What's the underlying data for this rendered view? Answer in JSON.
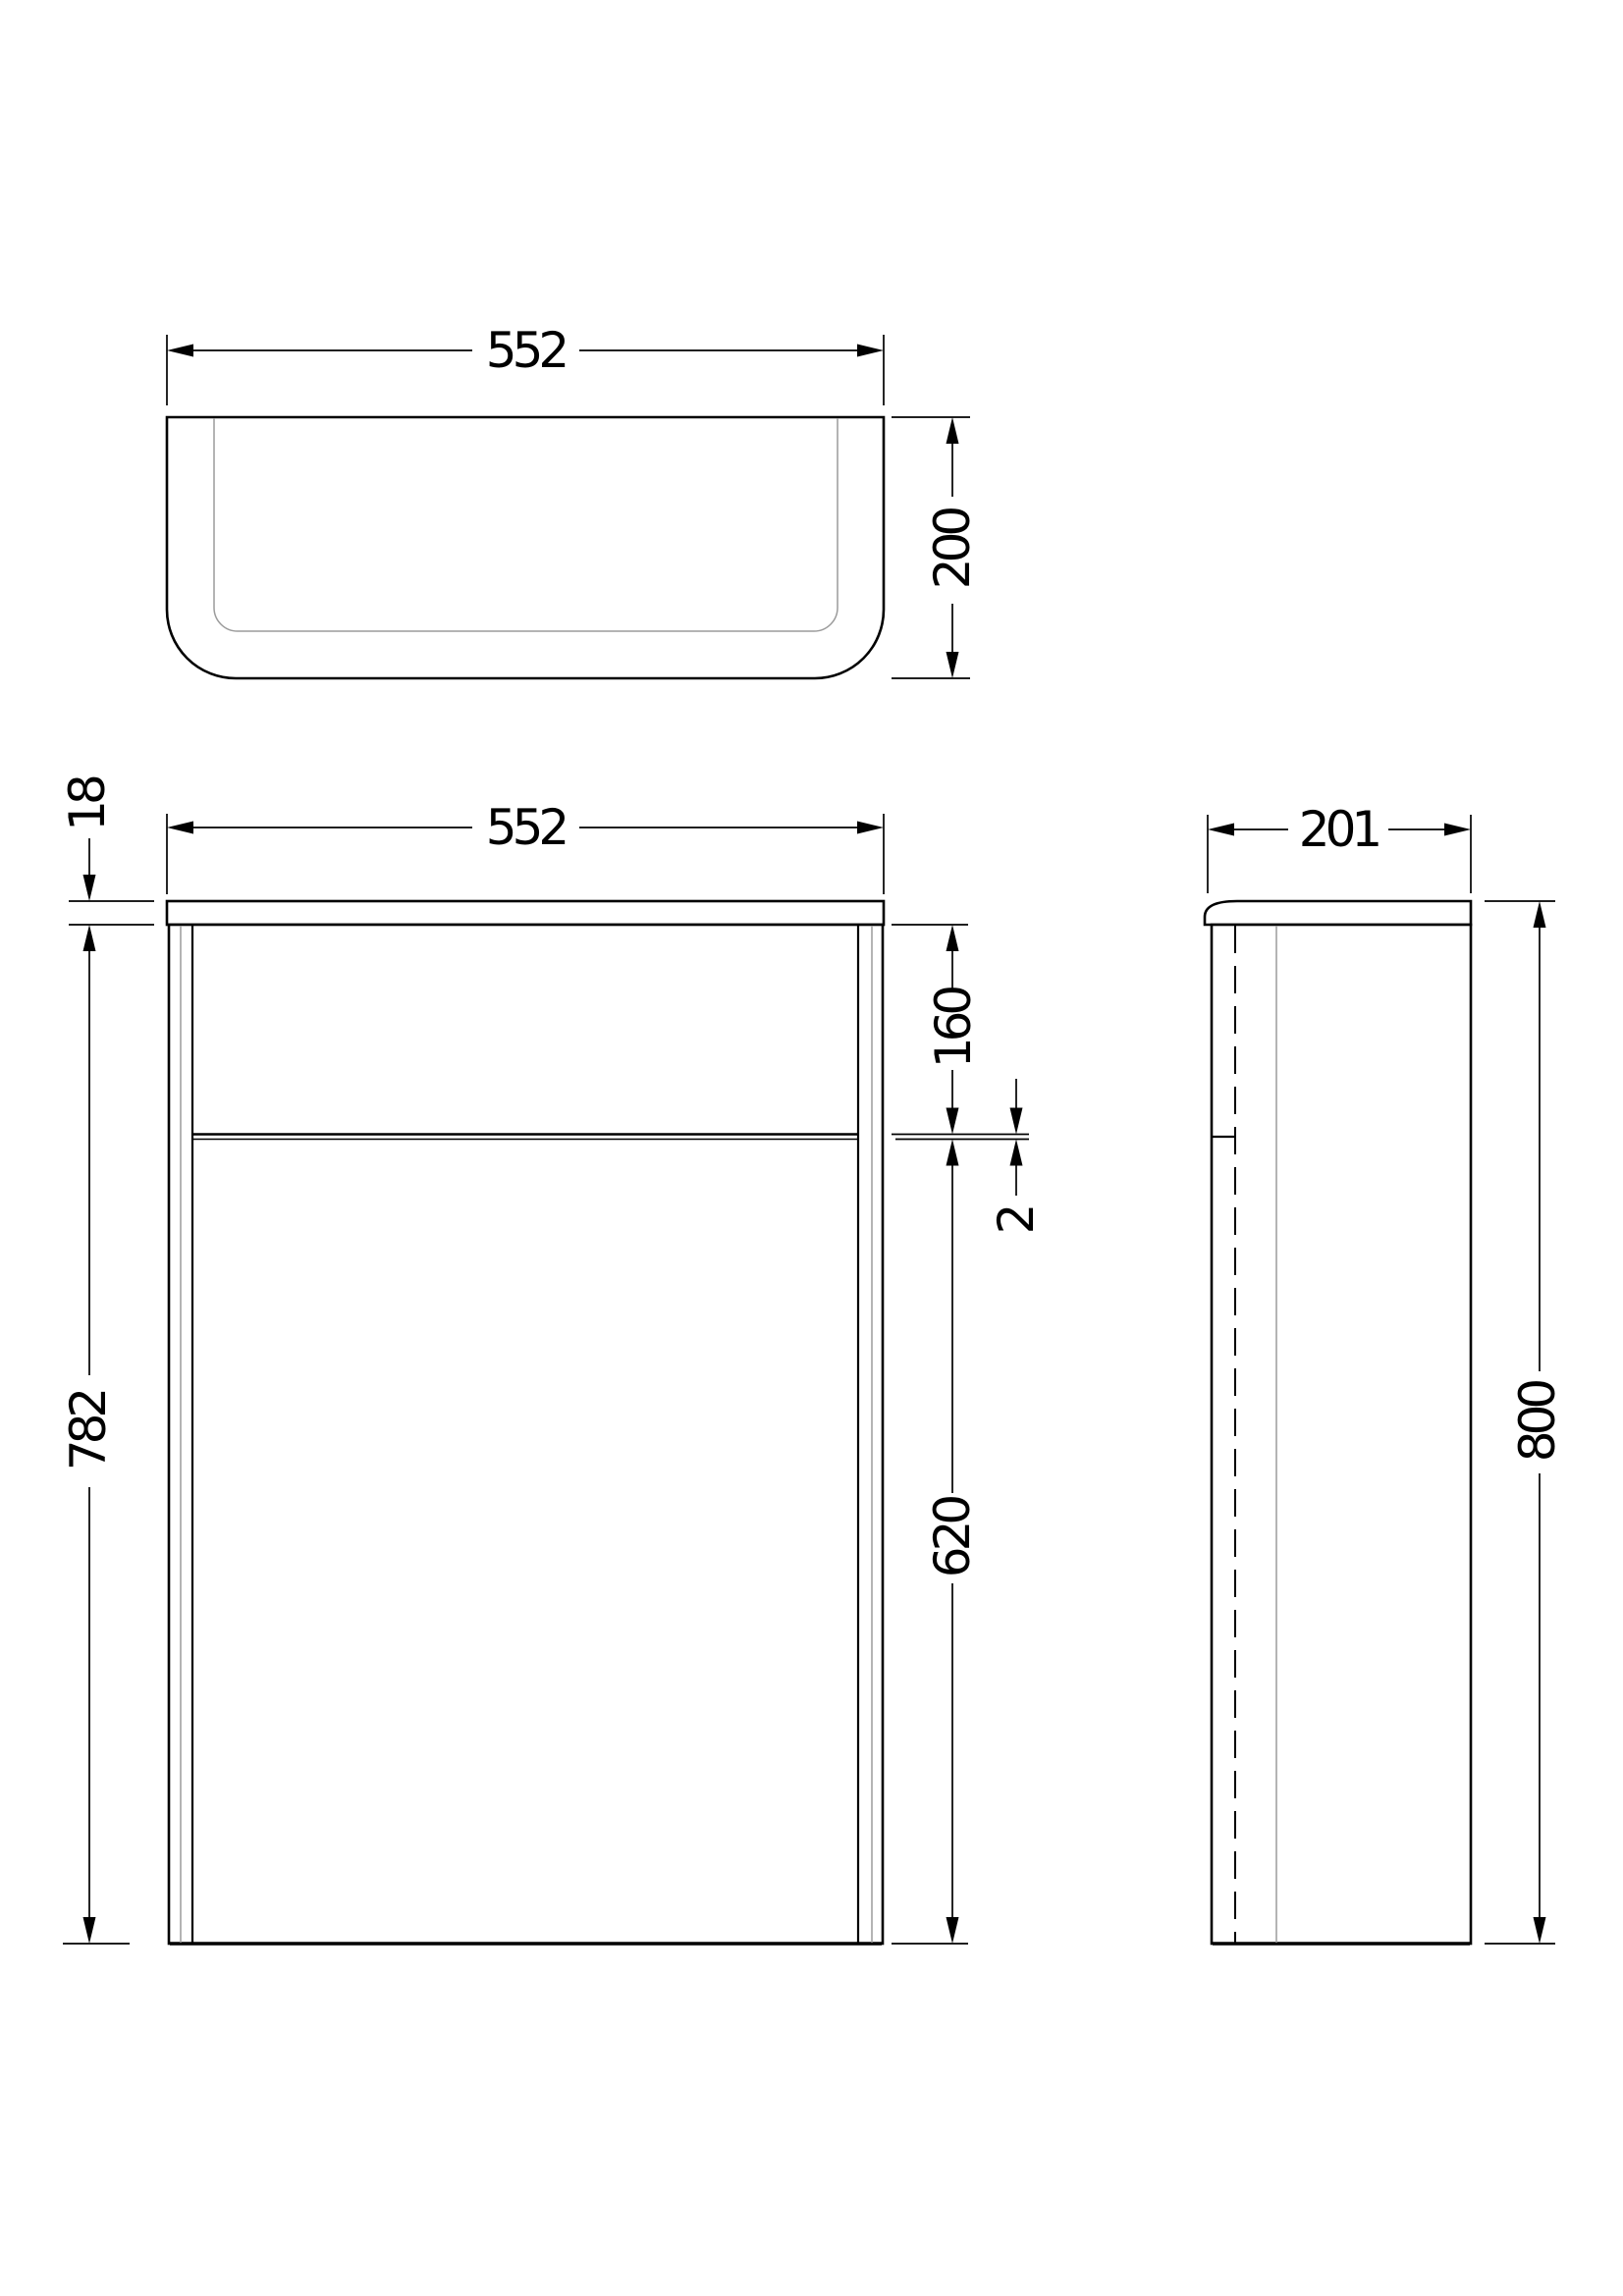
{
  "colors": {
    "line": "#000000",
    "secondary_line": "#9b9b9b",
    "background": "#ffffff"
  },
  "views": {
    "top": {
      "width": "552",
      "depth": "200"
    },
    "front": {
      "width": "552",
      "top_thickness": "18",
      "body_height": "782",
      "upper_section": "160",
      "shelf_thickness": "2",
      "lower_section": "620"
    },
    "side": {
      "depth": "201",
      "height": "800"
    }
  }
}
